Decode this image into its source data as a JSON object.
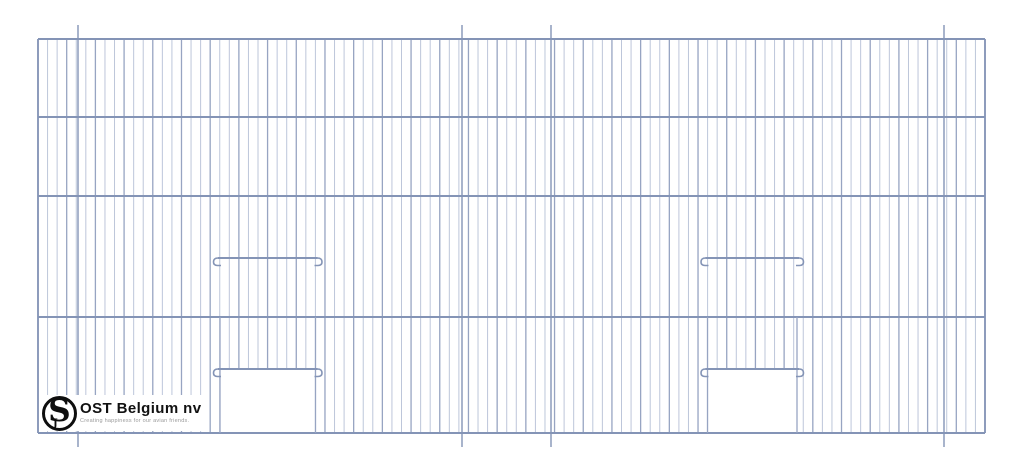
{
  "page": {
    "background": "#ffffff",
    "description": "Technical product drawing of a wire cage front panel with two sliding doors"
  },
  "logo": {
    "brand": "OST Belgium nv",
    "tagline": "Creating happiness for our avian friends.",
    "monogram": "S",
    "monogram_small": "J"
  },
  "drawing": {
    "canvas": {
      "width": 1024,
      "height": 473
    },
    "frame": {
      "left": 38,
      "right": 985,
      "top": 39,
      "bottom": 433
    },
    "horizontal_wire_ys": [
      39,
      117,
      196,
      317,
      433
    ],
    "vertical_wire_count": 100,
    "hanger_wire_xs": [
      78,
      462,
      551,
      944
    ],
    "hanger_extension": 14,
    "doors": [
      {
        "x1": 220,
        "x2": 315.5,
        "slide_bar_y": 258,
        "rail_y": 369
      },
      {
        "x1": 707.5,
        "x2": 797,
        "slide_bar_y": 258,
        "rail_y": 369
      }
    ],
    "colors": {
      "wire_light": "#bdc6da",
      "wire_dark": "#97a4c2",
      "frame_wire": "#8494b6"
    }
  }
}
